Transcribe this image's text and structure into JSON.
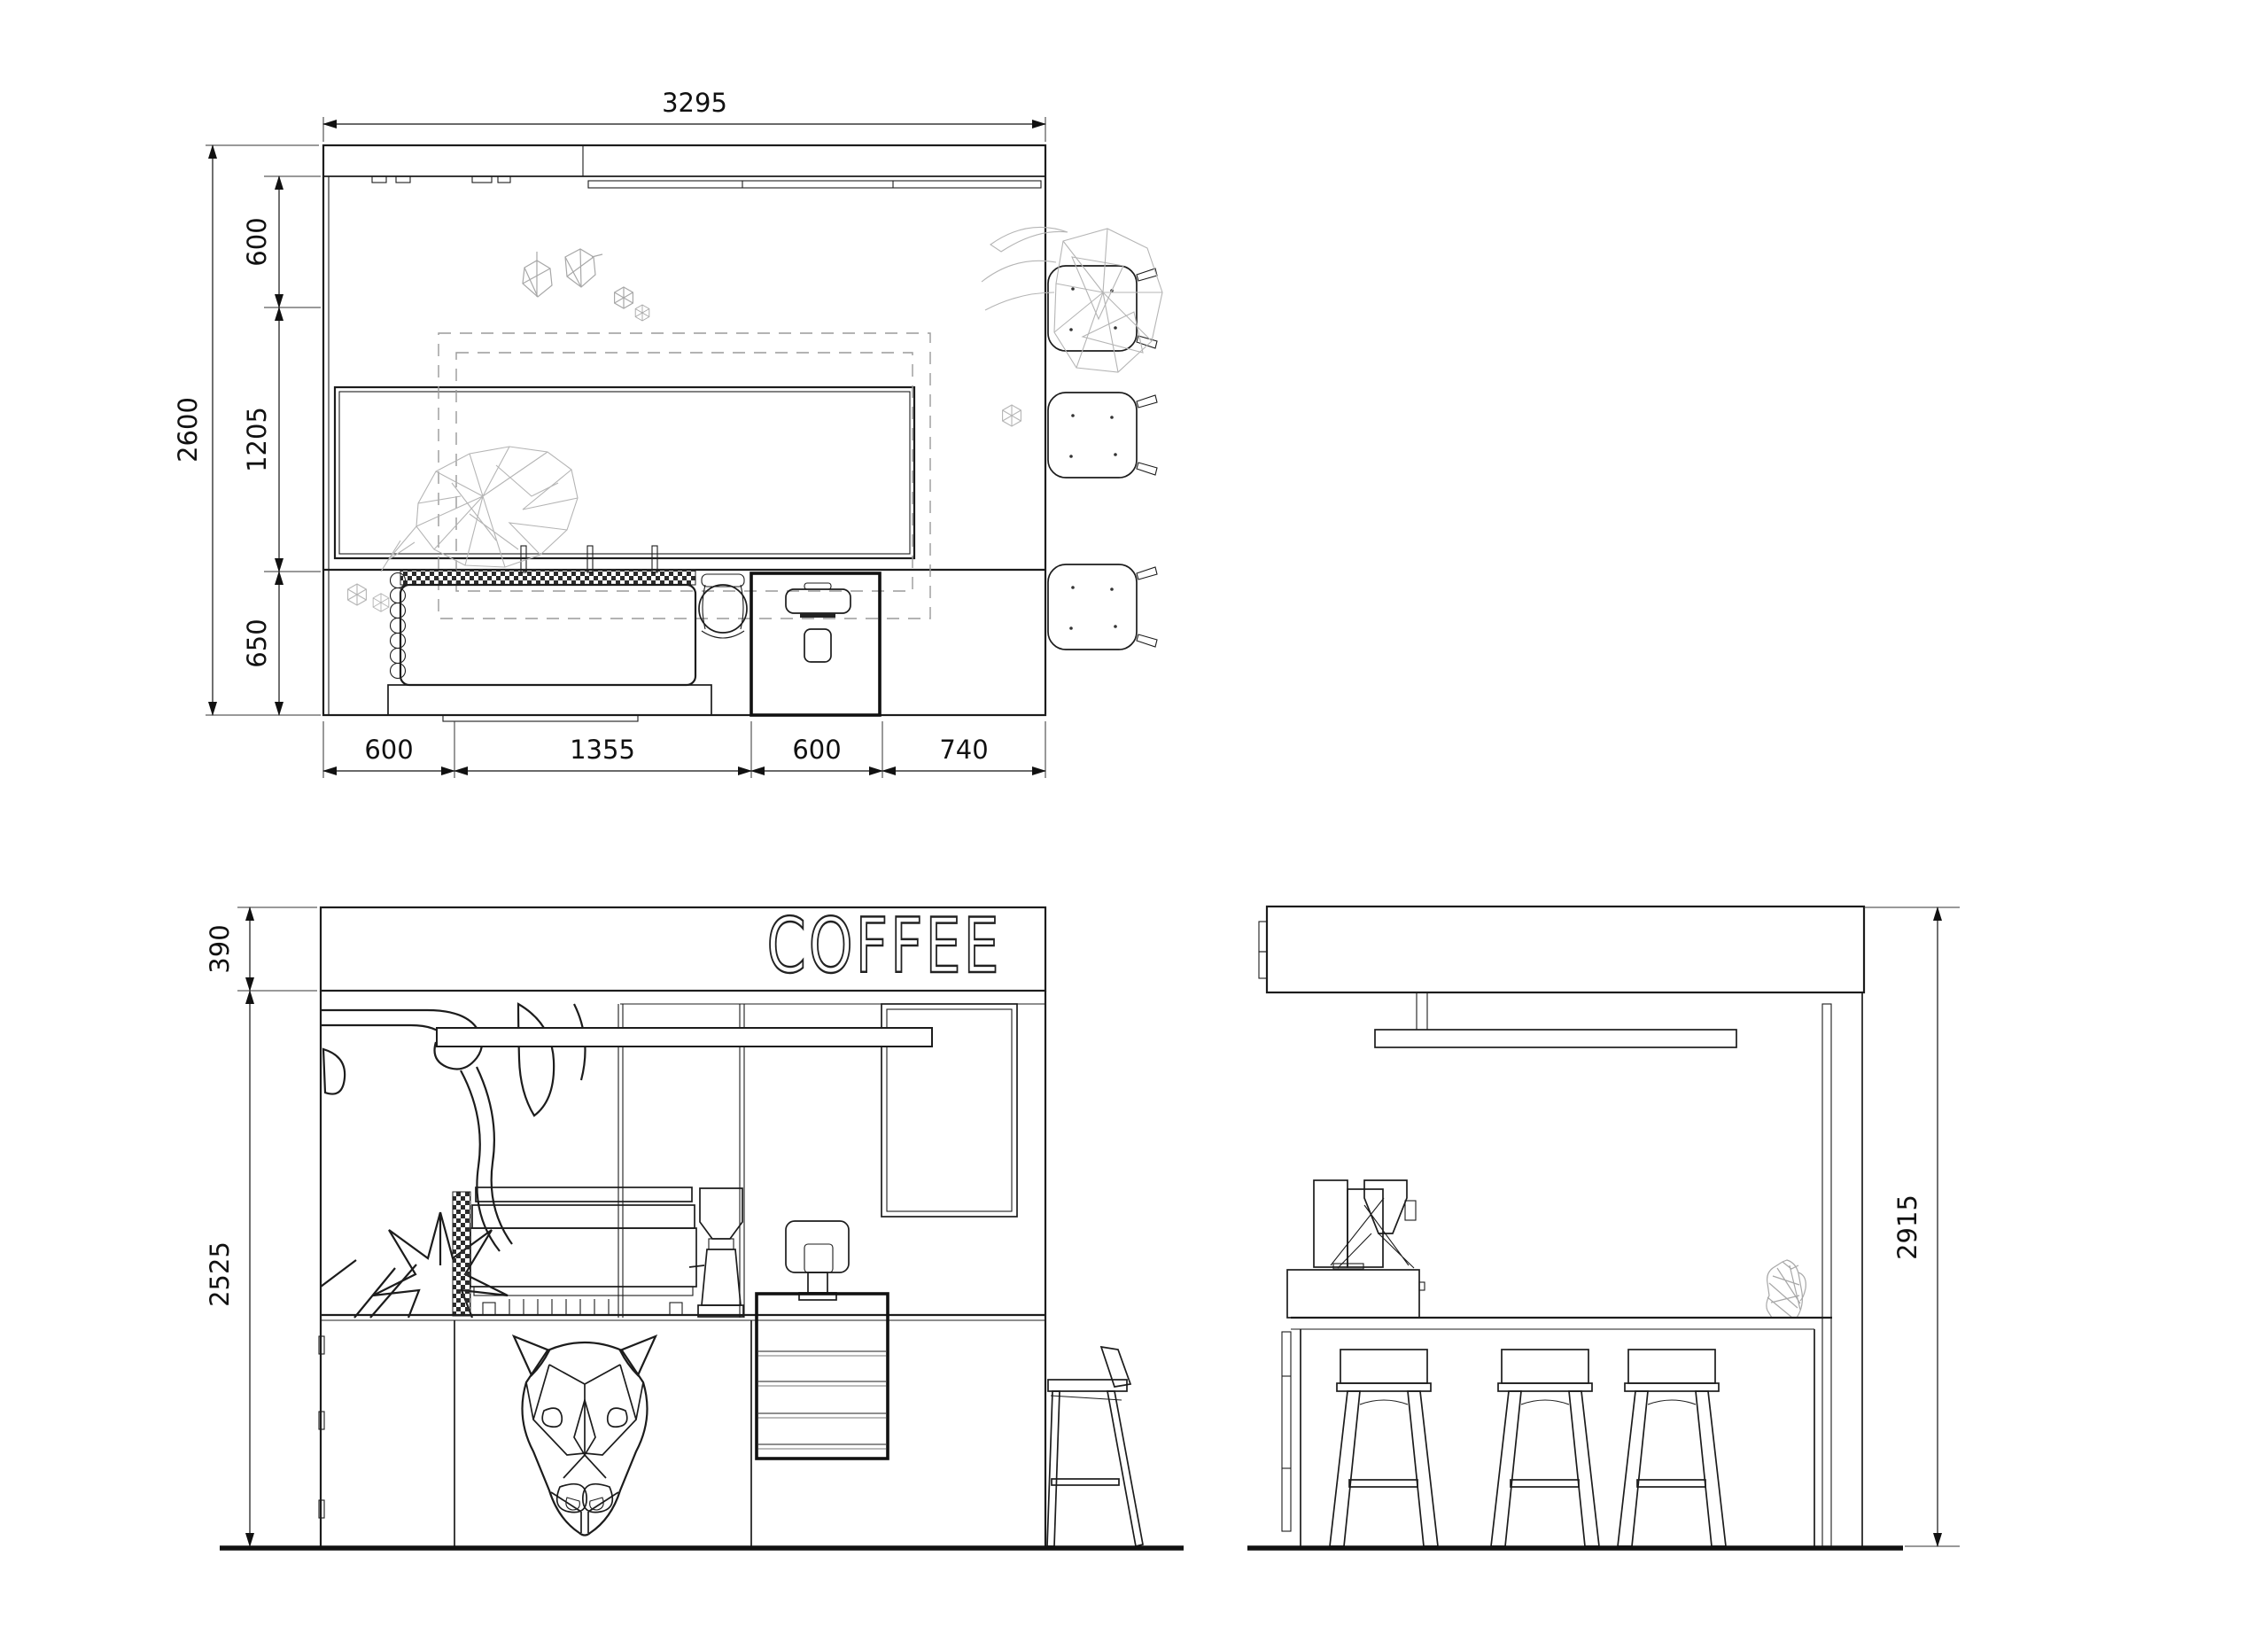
{
  "sign": {
    "text": "COFFEE"
  },
  "dimensions": {
    "plan": {
      "width": "3295",
      "height": "2600",
      "left": [
        "600",
        "1205",
        "650"
      ],
      "bottom": [
        "600",
        "1355",
        "600",
        "740"
      ]
    },
    "front": {
      "fascia": "390",
      "body": "2525"
    },
    "side": {
      "total": "2915"
    }
  },
  "colors": {
    "line": "#1c1c1c",
    "wireframe": "#b5b5b5",
    "dashed": "#9a9a9a",
    "background": "#ffffff"
  }
}
